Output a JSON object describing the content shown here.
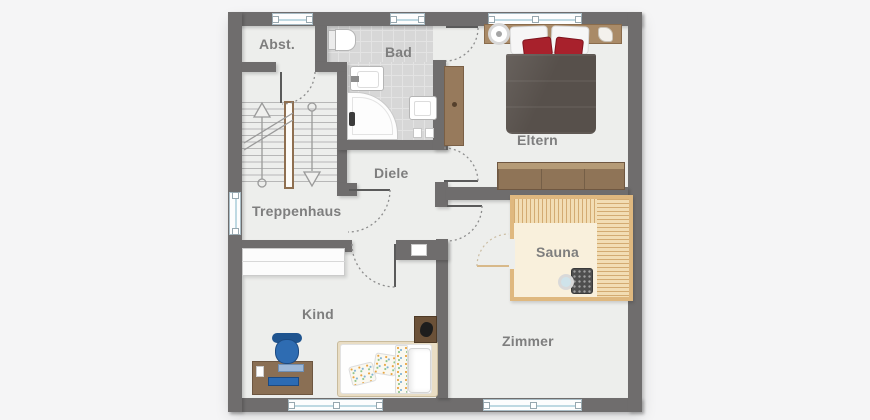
{
  "rooms": [
    {
      "id": "abst",
      "label": "Abst."
    },
    {
      "id": "bad",
      "label": "Bad"
    },
    {
      "id": "eltern",
      "label": "Eltern"
    },
    {
      "id": "diele",
      "label": "Diele"
    },
    {
      "id": "treppenhaus",
      "label": "Treppenhaus"
    },
    {
      "id": "sauna",
      "label": "Sauna"
    },
    {
      "id": "kind",
      "label": "Kind"
    },
    {
      "id": "zimmer",
      "label": "Zimmer"
    }
  ],
  "colors": {
    "wall": "#6f6d6d",
    "floor": "#edeeec",
    "background": "#f5f5f6",
    "bath_tile": "#d7d7d7",
    "sauna_wood_frame": "#dfb87f",
    "sauna_floor": "#f9f0dc",
    "parent_bed_duvet": "#57504b",
    "accent_pillow_red": "#a8212c",
    "furniture_wood": "#8a6f54",
    "kid_accent_blue": "#2e6cb2",
    "label_text": "#7e7e7e"
  },
  "elements": {
    "windows": {
      "top": 3,
      "left": 1,
      "bottom": 2
    },
    "doors_with_swing_arcs": 6,
    "sauna_door_arcs": 1,
    "furniture": [
      "staircase",
      "toilet",
      "washbasin",
      "corner-bathtub",
      "hand-basin",
      "double-bed",
      "bedside-lamp",
      "wardrobe",
      "sideboard",
      "sauna-benches",
      "sauna-stove",
      "sauna-bucket",
      "child-bed",
      "bedside-table",
      "desk",
      "desk-chair",
      "monitor",
      "keyboard"
    ]
  }
}
